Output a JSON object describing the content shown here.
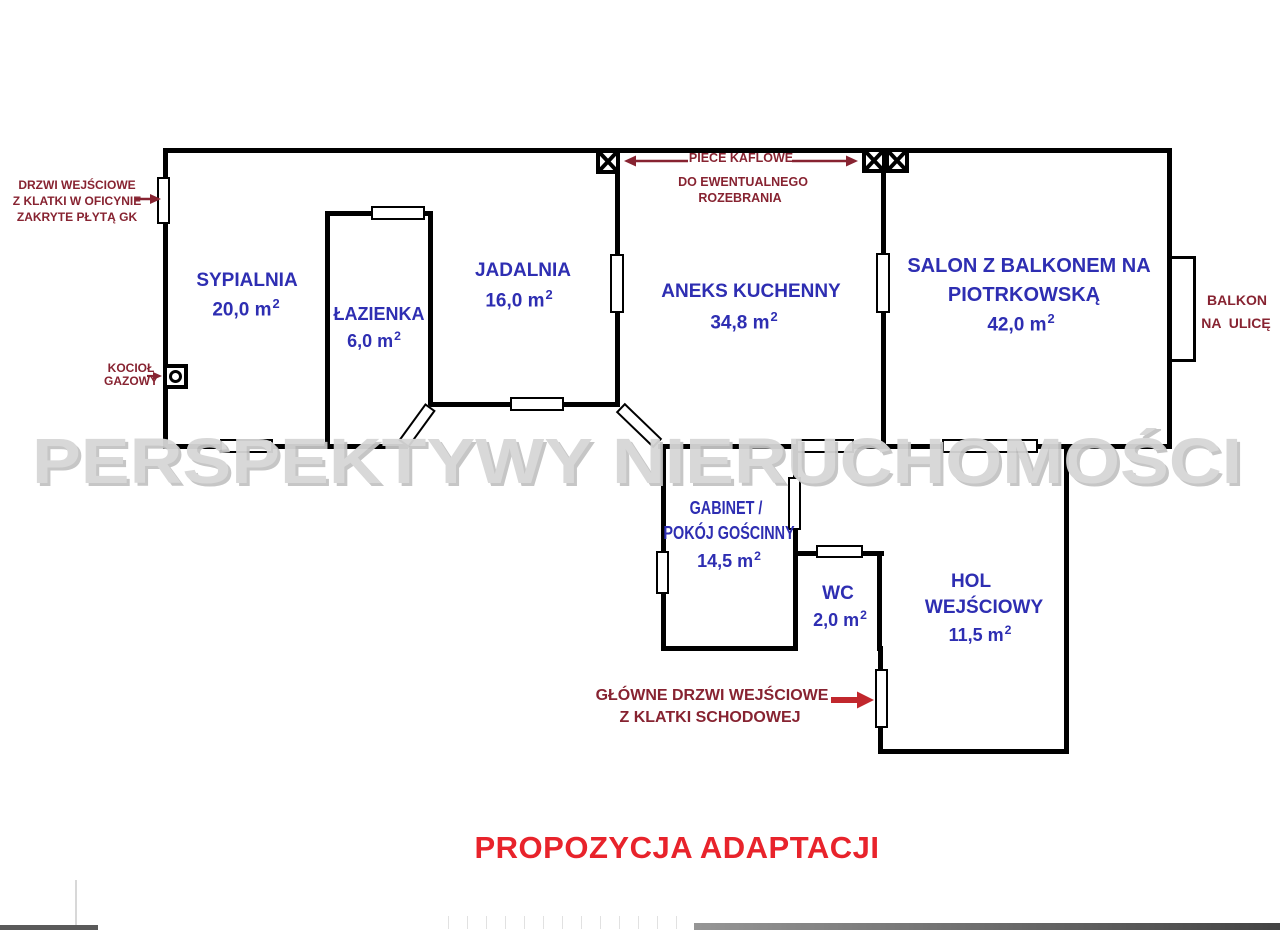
{
  "watermark": "PERSPEKTYWY NIERUCHOMOŚCI",
  "title": "PROPOZYCJA ADAPTACJI",
  "unit": {
    "exp": "2"
  },
  "rooms": {
    "sypialnia": {
      "label": "SYPIALNIA",
      "area": "20,0 m"
    },
    "lazienka": {
      "label": "ŁAZIENKA",
      "area": "6,0 m"
    },
    "jadalnia": {
      "label": "JADALNIA",
      "area": "16,0 m"
    },
    "aneks": {
      "label": "ANEKS KUCHENNY",
      "area": "34,8 m"
    },
    "salon": {
      "label1": "SALON Z BALKONEM NA",
      "label2": "PIOTRKOWSKĄ",
      "area": "42,0 m"
    },
    "gabinet": {
      "label1": "GABINET /",
      "label2": "POKÓJ GOŚCINNY",
      "area": "14,5 m"
    },
    "wc": {
      "label": "WC",
      "area": "2,0 m"
    },
    "hol": {
      "label1": "HOL",
      "label2": "WEJŚCIOWY",
      "area": "11,5 m"
    }
  },
  "annotations": {
    "entry_door": {
      "line1": "DRZWI WEJŚCIOWE",
      "line2": "Z KLATKI W OFICYNIE",
      "line3": "ZAKRYTE PŁYTĄ GK"
    },
    "boiler": {
      "line1": "KOCIOŁ",
      "line2": "GAZOWY"
    },
    "stoves": {
      "line1": "PIECE KAFLOWE",
      "line2": "DO EWENTUALNEGO",
      "line3": "ROZEBRANIA"
    },
    "balcony": {
      "line1": "BALKON",
      "line2": "NA  ULICĘ"
    },
    "main_door": {
      "line1": "GŁÓWNE DRZWI WEJŚCIOWE",
      "line2": "Z KLATKI SCHODOWEJ"
    }
  },
  "colors": {
    "room_label": "#2e2eb2",
    "annotation": "#872331",
    "title_red": "#e8232b",
    "arrow_red": "#c1272d",
    "watermark": "#d6d6d6",
    "wall": "#000000"
  }
}
